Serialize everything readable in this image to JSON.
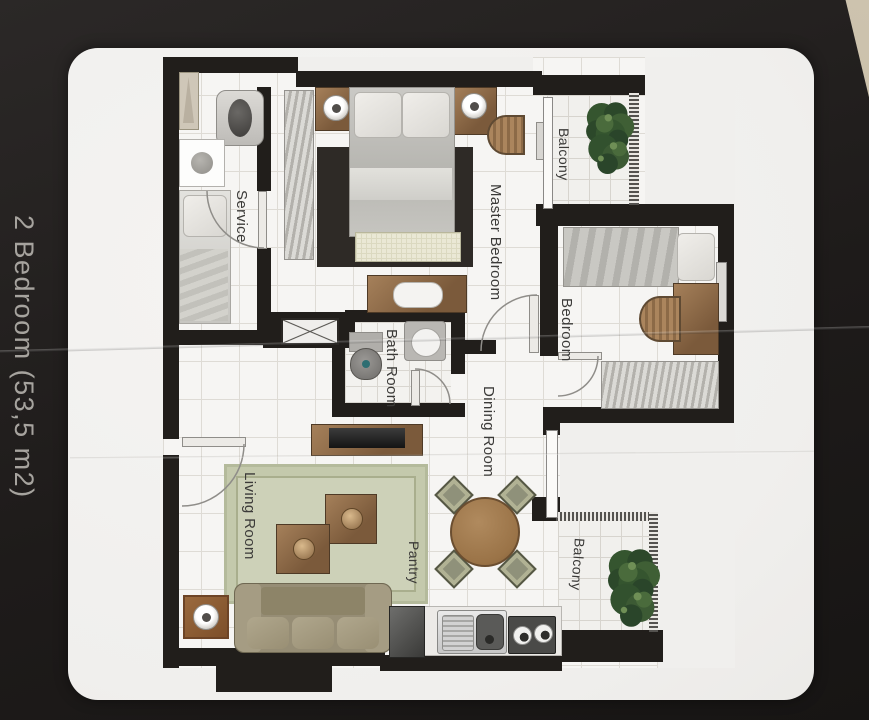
{
  "title": "2 Bedroom (53,5 m2)",
  "rooms": {
    "service": "Service",
    "master_bedroom": "Master Bedroom",
    "balcony_top": "Balcony",
    "bedroom": "Bedroom",
    "bath_room": "Bath Room",
    "dining_room": "Dining Room",
    "living_room": "Living Room",
    "pantry": "Pantry",
    "balcony_bottom": "Balcony"
  },
  "colors": {
    "backdrop": "#c3b9a5",
    "page_bg": "#201d1c",
    "card_bg": "#f0efed",
    "wall": "#211e1b",
    "wood": "#7b5a3b",
    "wood_light": "#a5805a",
    "plant": "#35552f",
    "rug": "#cdd1b8",
    "table_wood": "#a2783f",
    "label_text": "#3b3a38",
    "title_text": "#a6a39e"
  }
}
